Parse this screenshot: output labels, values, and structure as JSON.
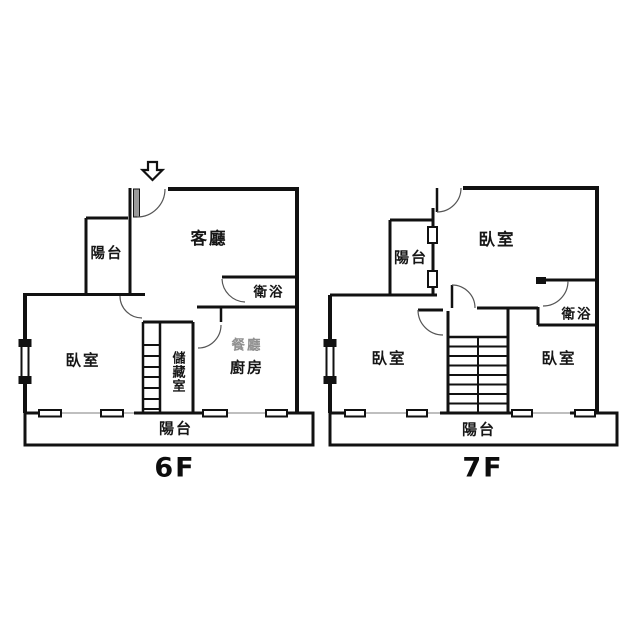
{
  "floors": [
    {
      "label": "6F",
      "rooms": {
        "balcony_top": "陽台",
        "living_room": "客廳",
        "bathroom": "衛浴",
        "bedroom": "臥室",
        "storage": "儲藏室",
        "dining": "餐廳",
        "kitchen": "廚房",
        "balcony_bottom": "陽台"
      }
    },
    {
      "label": "7F",
      "rooms": {
        "balcony_top": "陽台",
        "bedroom_top": "臥室",
        "bathroom": "衛浴",
        "bedroom_left": "臥室",
        "bedroom_right": "臥室",
        "balcony_bottom": "陽台"
      }
    }
  ],
  "icons": {
    "entrance_arrow": "down-arrow-icon"
  },
  "colors": {
    "wall": "#111111",
    "door_arc": "#555555",
    "light_line": "#aaaaaa",
    "dining_label": "#8f8f8f",
    "background": "#ffffff"
  }
}
